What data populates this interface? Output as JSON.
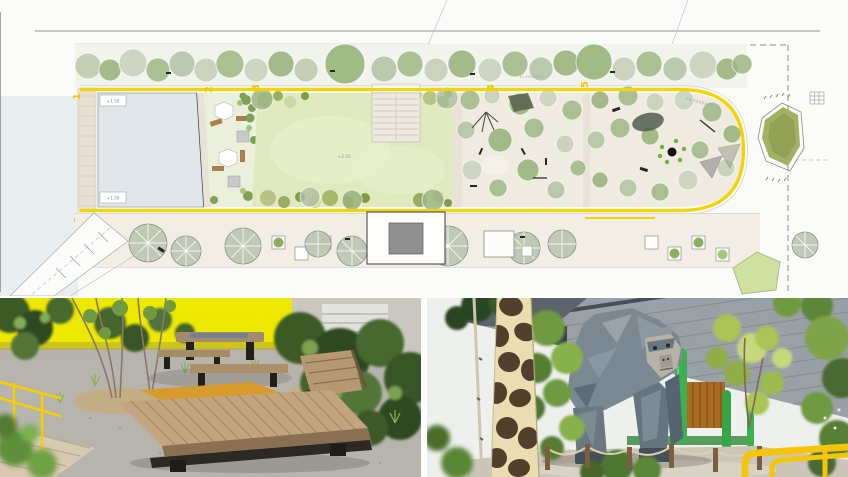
{
  "plan": {
    "zone_labels": [
      "1",
      "2",
      "3",
      "4",
      "5"
    ],
    "annotations": {
      "pool_notch_top": "+1.50",
      "pool_notch_bottom": "+1.50",
      "lawn_level": "+2.50",
      "street_label_left": "ELEMENTS",
      "street_label_right": "FR PASSAGE"
    },
    "colors": {
      "path_yellow": "#F2D500",
      "lawn_green": "#E1EABF",
      "pool_blue_gray": "#E0E6EA",
      "playground_beige": "#F0EBE0",
      "sidewalk_beige": "#F2EEE6",
      "water_margin": "#E9EEF1"
    }
  },
  "photos": {
    "left_colors": {
      "wall_yellow": "#EDE800",
      "wood_platform": "#C3A47F",
      "gravel_gray": "#B6B3AD"
    },
    "right_colors": {
      "gorilla_gray": "#7B8892",
      "giraffe_cream": "#E8DEB2",
      "giraffe_brown": "#52402C",
      "railing_yellow": "#F5C50C"
    }
  }
}
